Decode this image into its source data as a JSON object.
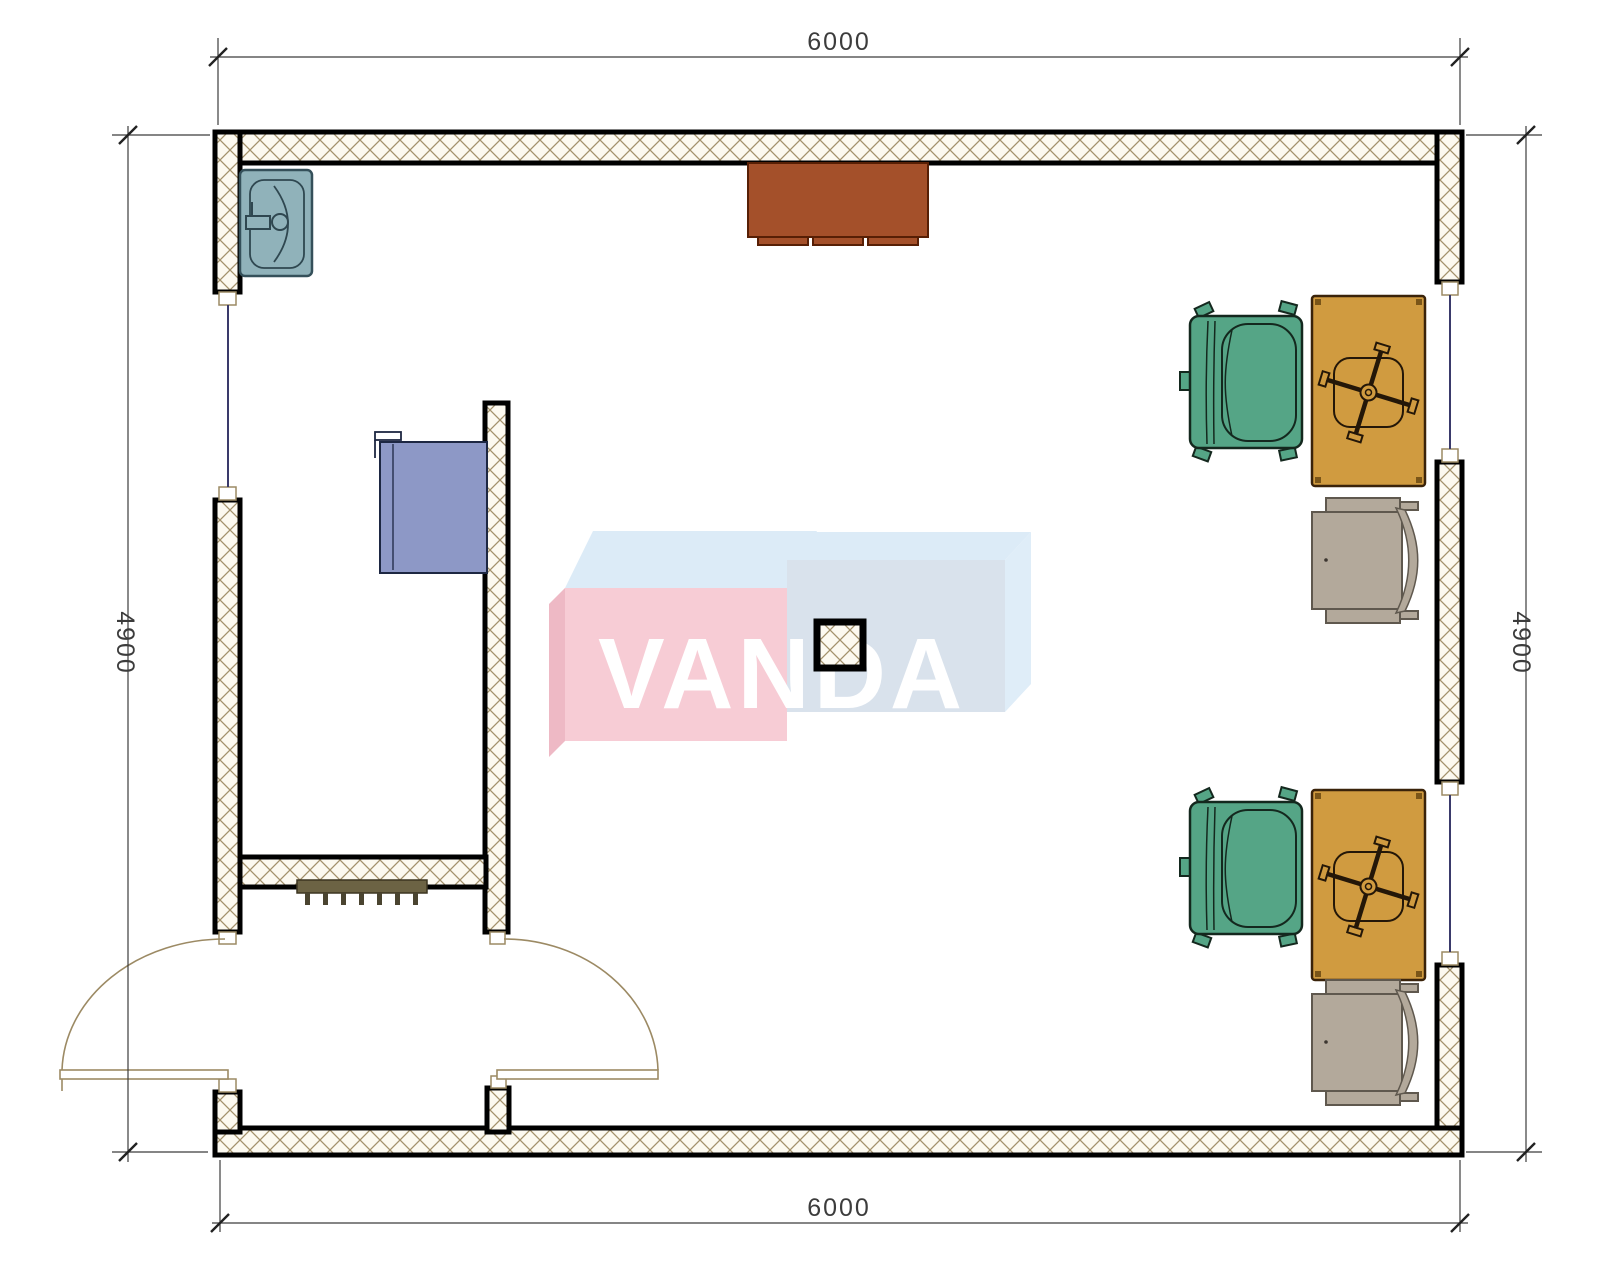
{
  "drawing": {
    "type": "architectural-floor-plan",
    "dimensions": {
      "top": "6000",
      "bottom": "6000",
      "left": "4900",
      "right": "4900"
    },
    "watermark": {
      "text": "VANDA"
    },
    "furniture_legend": {
      "sink": "sink-basin",
      "sideboard": "brown-sideboard",
      "cabinet": "blue-wall-cabinet",
      "desk": "desk-with-task-chair",
      "armchair": "green-office-armchair",
      "side_chair": "gray-visitor-chair",
      "radiator": "radiator-grille",
      "column": "structural-column",
      "doors": "double-entry-doors",
      "windows": "three-windows"
    },
    "colors": {
      "wall_fill": "#fcf9f0",
      "hatch_line": "#a3916c",
      "window_line": "#3a3a6b",
      "door_line": "#9c8a64",
      "dim_line": "#3c3c3c",
      "sink": "#90b2ba",
      "cabinet_brown": "#a4502a",
      "cabinet_blue": "#8d98c6",
      "desk": "#d09b40",
      "chair_green": "#55a586",
      "chair_gray": "#b3a99b",
      "radiator": "#6c6344",
      "wm_pink_front": "#f7ccd5",
      "wm_pink_side": "#eeb9c5",
      "wm_top_face": "#dcebf7",
      "wm_blue_front": "#d9e2ec",
      "wm_blue_side": "#dfedf8",
      "wm_text": "#ffffff"
    }
  }
}
